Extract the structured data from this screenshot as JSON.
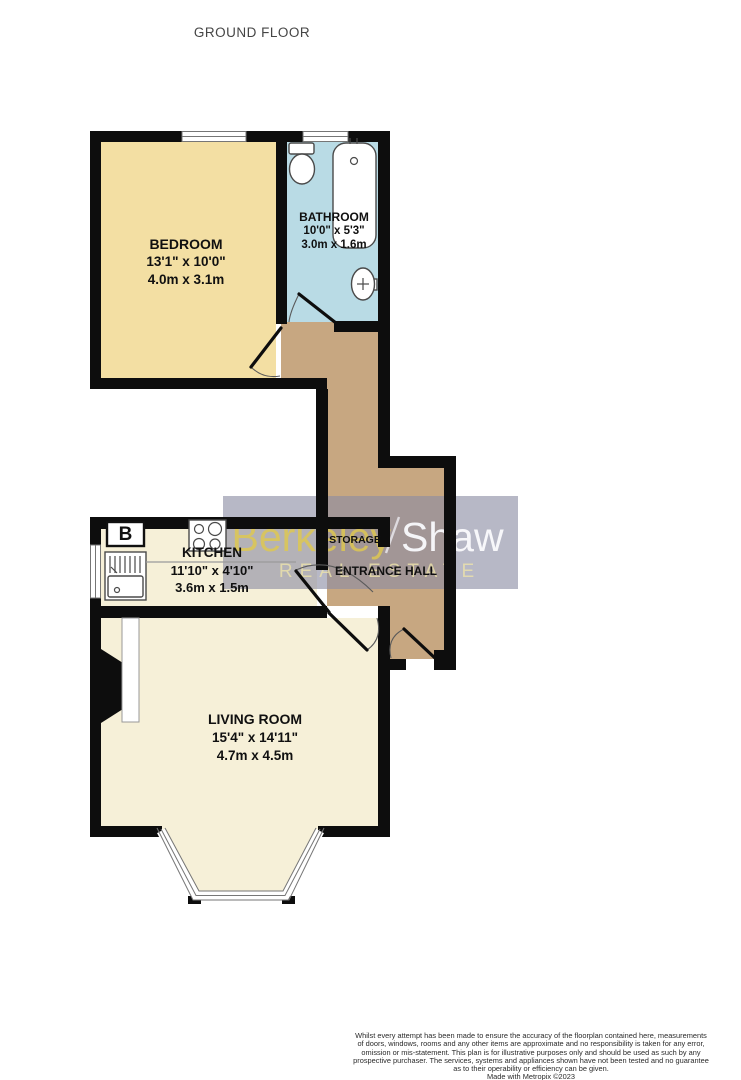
{
  "page": {
    "title": "GROUND FLOOR"
  },
  "branding": {
    "name_left": "Berkeley",
    "name_right": "Shaw",
    "tagline": "REAL ESTATE"
  },
  "rooms": {
    "bedroom": {
      "name": "BEDROOM",
      "imperial": "13'1\"  x 10'0\"",
      "metric": "4.0m  x 3.1m"
    },
    "bathroom": {
      "name": "BATHROOM",
      "imperial": "10'0\"  x 5'3\"",
      "metric": "3.0m  x 1.6m"
    },
    "kitchen": {
      "name": "KITCHEN",
      "imperial": "11'10\"  x 4'10\"",
      "metric": "3.6m  x 1.5m"
    },
    "storage": {
      "name": "STORAGE"
    },
    "entrance_hall": {
      "name": "ENTRANCE HALL"
    },
    "living_room": {
      "name": "LIVING ROOM",
      "imperial": "15'4\"  x 14'11\"",
      "metric": "4.7m  x 4.5m"
    }
  },
  "fixtures": {
    "boiler_label": "B"
  },
  "footer": {
    "lines": [
      "Whilst every attempt has been made to ensure the accuracy of the floorplan contained here, measurements",
      "of doors, windows, rooms and any other items are approximate and no responsibility is taken for any error,",
      "omission or mis-statement. This plan is for illustrative purposes only and should be used as such by any",
      "prospective purchaser. The services, systems and appliances shown have not been tested and no guarantee",
      "as to their operability or efficiency can be given.",
      "Made with Metropix ©2023"
    ]
  },
  "colors": {
    "wall": "#0d0d0d",
    "bedroom": "#F3DFA3",
    "bathroom": "#B9DBE5",
    "hall": "#C7A781",
    "kitchen": "#F6F0D8",
    "living_room": "#F6F0D8",
    "brand_yellow": "#DDC752",
    "brand_white": "#FAFAFD"
  }
}
